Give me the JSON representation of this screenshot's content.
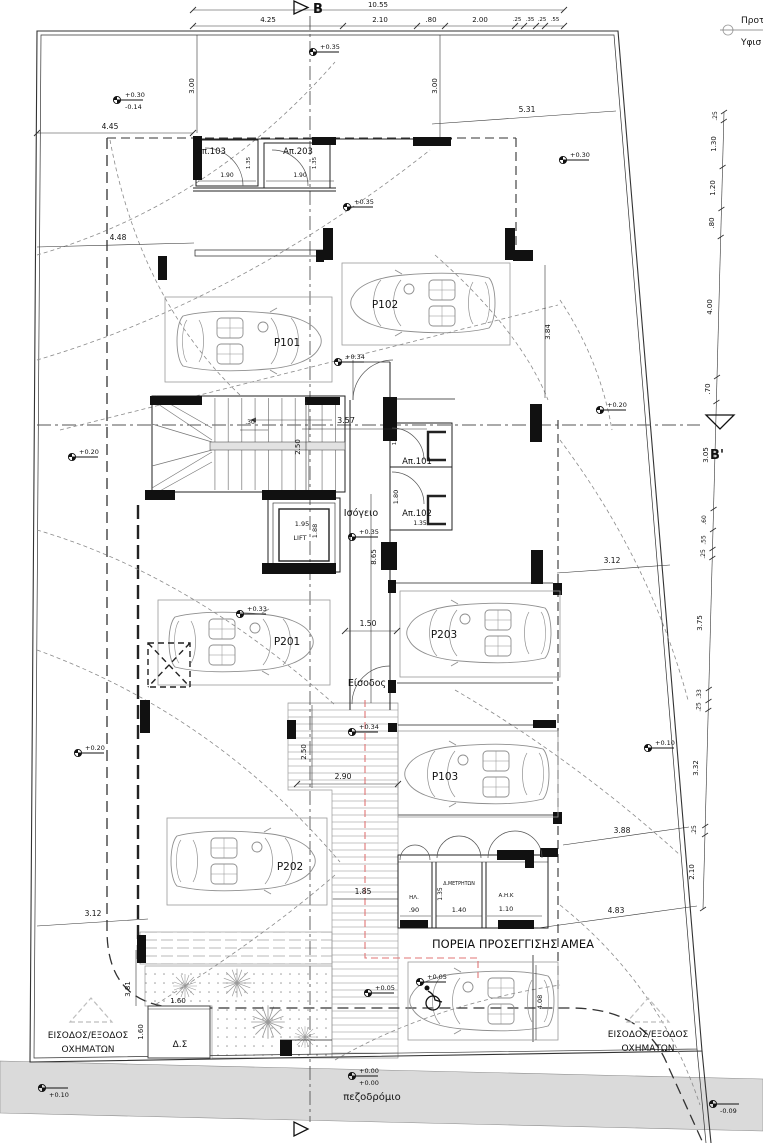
{
  "legend": {
    "proposed": "Προτ",
    "existing": "Υφισ"
  },
  "sections": {
    "b": "B",
    "b_prime": "B'"
  },
  "floor": {
    "name": "Ισόγειο",
    "lift": "LIFT",
    "entrance": "Είσοδος",
    "sidewalk": "πεζοδρόμιο"
  },
  "rooms": {
    "ap101": "Απ.101",
    "ap102": "Απ.102",
    "ap103": "Απ.103",
    "ap203": "Απ.203",
    "electrical": "ΗΛ.",
    "meters": "Δ.ΜΕΤΡΗΤΩΝ",
    "ahk": "Α.Η.Κ",
    "bins": "Δ.Σ"
  },
  "parking": {
    "p101": "P101",
    "p102": "P102",
    "p103": "P103",
    "p201": "P201",
    "p202": "P202",
    "p203": "P203"
  },
  "notes": {
    "amea_route": "ΠΟΡΕΙΑ ΠΡΟΣΕΓΓΙΣΗΣ ΑΜΕΑ",
    "vehicle_access": "ΕΙΣΟΔΟΣ/ΕΞΟΔΟΣ",
    "vehicles": "ΟΧΗΜΑΤΩΝ"
  },
  "levels": {
    "p030": "+0.30",
    "m014": "-0.14",
    "p035": "+0.35",
    "p034": "+0.34",
    "p033": "+0.33",
    "p020": "+0.20",
    "p010": "+0.10",
    "p005": "+0.05",
    "p000": "+0.00",
    "m009": "-0.09"
  },
  "dims": {
    "top_total": "10.55",
    "top": [
      "4.25",
      "2.10",
      ".80",
      "2.00",
      ".25",
      ".35",
      ".25",
      ".55"
    ],
    "right": [
      ".25",
      "1.30",
      "1.20",
      ".80",
      "4.00",
      ".70",
      "3.05",
      ".60",
      ".55",
      ".25",
      "3.75",
      ".33",
      ".25",
      "3.32",
      ".25",
      "2.10"
    ],
    "plan": {
      "d445": "4.45",
      "d448": "4.48",
      "d531": "5.31",
      "d300": "3.00",
      "d190": "1.90",
      "d135": "1.35",
      "d384": "3.84",
      "d357": "3.57",
      "d250": "2.50",
      "d030": ".30",
      "d195": "1.95",
      "d188": "1.88",
      "d160s": "1.6",
      "d180": "1.80",
      "d865": "8.65",
      "d150": "1.50",
      "d312": "3.12",
      "d290": "2.90",
      "d185": "1.85",
      "d388": "3.88",
      "d483": "4.83",
      "d381": "3.81",
      "d160": "1.60",
      "d090": ".90",
      "d140": "1.40",
      "d110": "1.10",
      "d408": "4.08"
    }
  }
}
